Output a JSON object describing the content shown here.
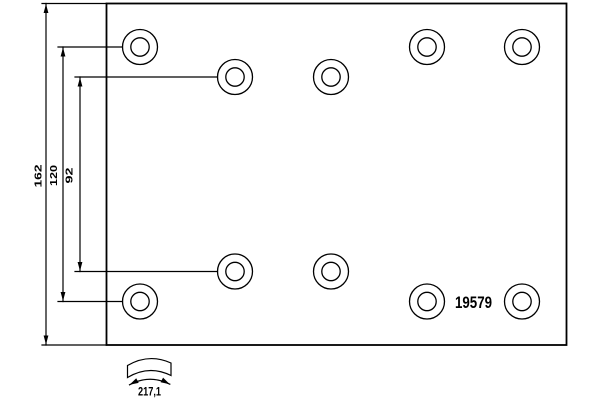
{
  "drawing": {
    "part_number": "19579",
    "dimensions": {
      "total_height": "162",
      "outer_hole_spacing": "120",
      "inner_hole_spacing": "92",
      "arc_width": "217,1"
    },
    "colors": {
      "line": "#000000",
      "background": "#ffffff"
    },
    "holes": [
      {
        "cx": 140,
        "cy": 47
      },
      {
        "cx": 235,
        "cy": 77
      },
      {
        "cx": 331,
        "cy": 77
      },
      {
        "cx": 427,
        "cy": 47
      },
      {
        "cx": 522,
        "cy": 47
      },
      {
        "cx": 140,
        "cy": 301.5
      },
      {
        "cx": 235,
        "cy": 271.5
      },
      {
        "cx": 331,
        "cy": 271.5
      },
      {
        "cx": 427,
        "cy": 301.5
      },
      {
        "cx": 522,
        "cy": 301.5
      }
    ],
    "hole_outer_radius": 17.5,
    "hole_inner_radius": 9.2
  }
}
